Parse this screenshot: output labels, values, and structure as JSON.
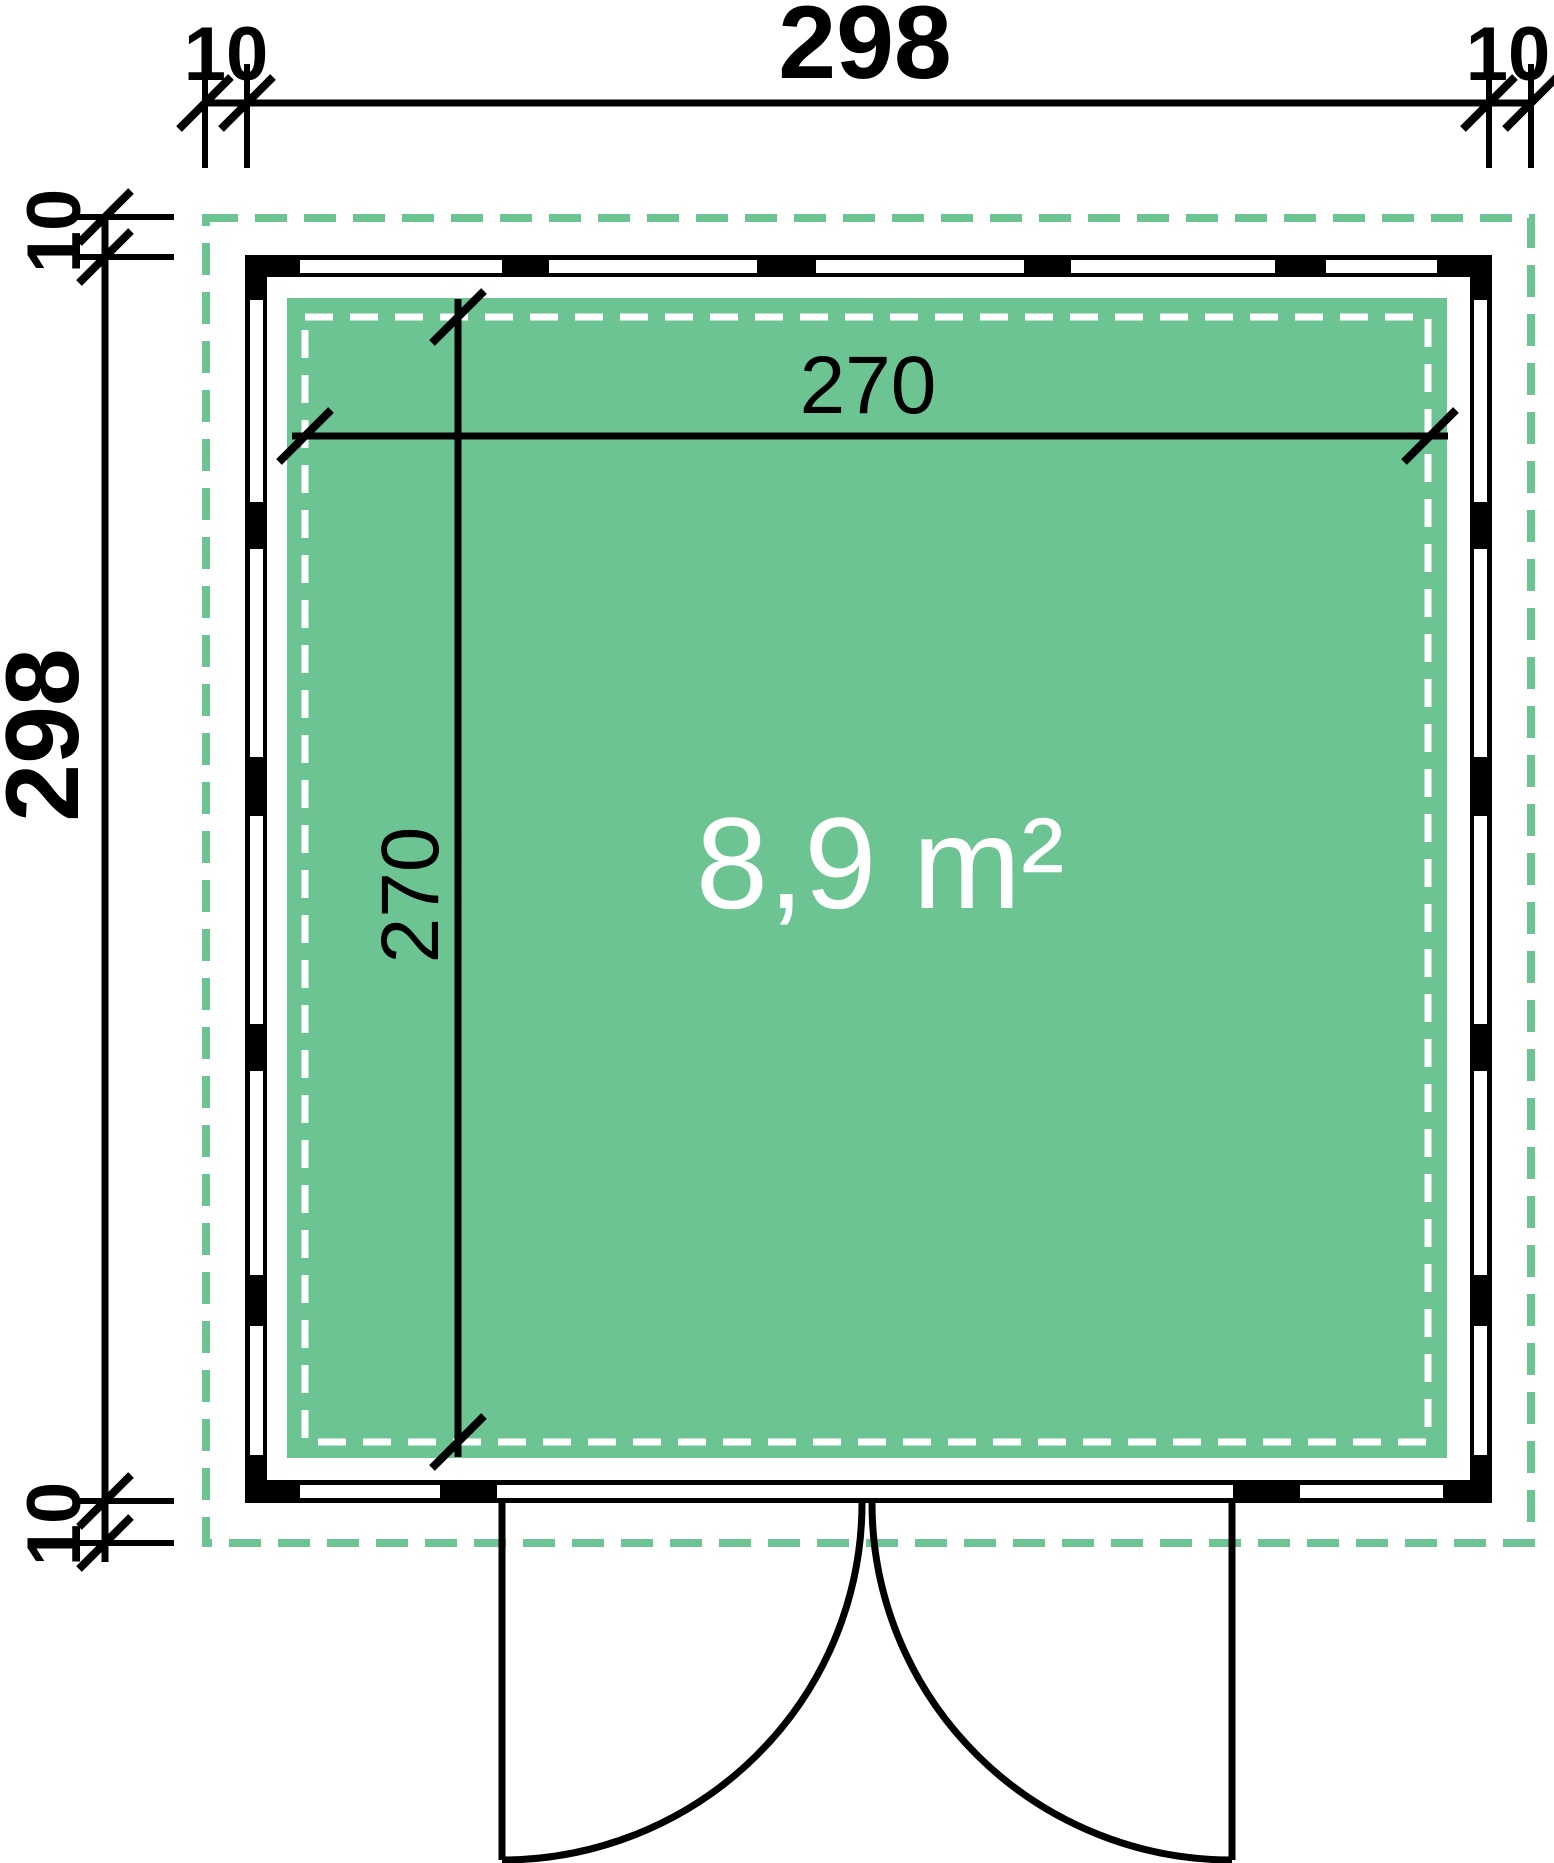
{
  "plan": {
    "outer_width_label": "298",
    "outer_height_label": "298",
    "inner_width_label": "270",
    "inner_height_label": "270",
    "area_label": "8,9 m²",
    "overhang_top_left": "10",
    "overhang_top_right": "10",
    "overhang_left_top": "10",
    "overhang_left_bottom": "10",
    "colors": {
      "accent_green": "#6CC493",
      "wall_black": "#000000",
      "background_white": "#FFFFFF"
    }
  }
}
